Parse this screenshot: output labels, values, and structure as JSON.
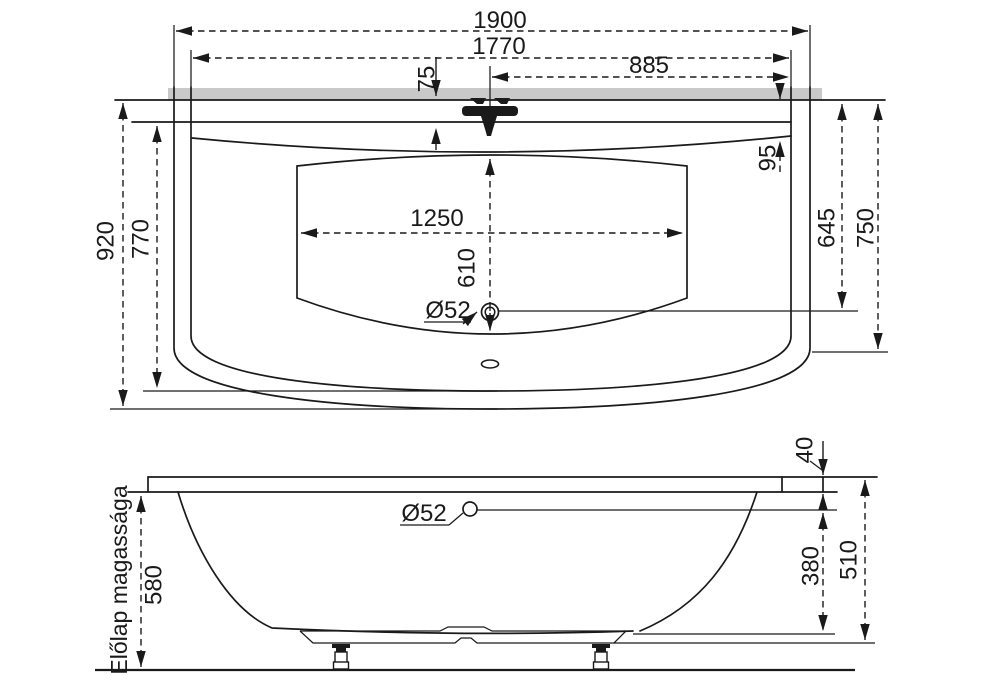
{
  "drawing_type": "bathtub technical dimension drawing",
  "colors": {
    "line": "#1a1a1a",
    "wall_strip": "#c9c9c9",
    "background": "#ffffff"
  },
  "top_view": {
    "dim_overall_length": "1900",
    "dim_rim_inner_length": "1770",
    "dim_center_to_edge": "885",
    "dim_back_rim_width": "75",
    "dim_rim_to_basin_edge": "95",
    "dim_overall_width": "920",
    "dim_rim_inner_width": "770",
    "dim_drain_depth": "645",
    "dim_side_depth": "750",
    "dim_floor_length": "1250",
    "dim_floor_width": "610",
    "dim_drain_diameter": "Ø52"
  },
  "side_view": {
    "dim_rim_thickness": "40",
    "dim_overflow_diameter": "Ø52",
    "dim_overflow_height": "380",
    "dim_shell_height": "510",
    "dim_total_height": "580",
    "front_panel_label": "Előlap magassága"
  }
}
